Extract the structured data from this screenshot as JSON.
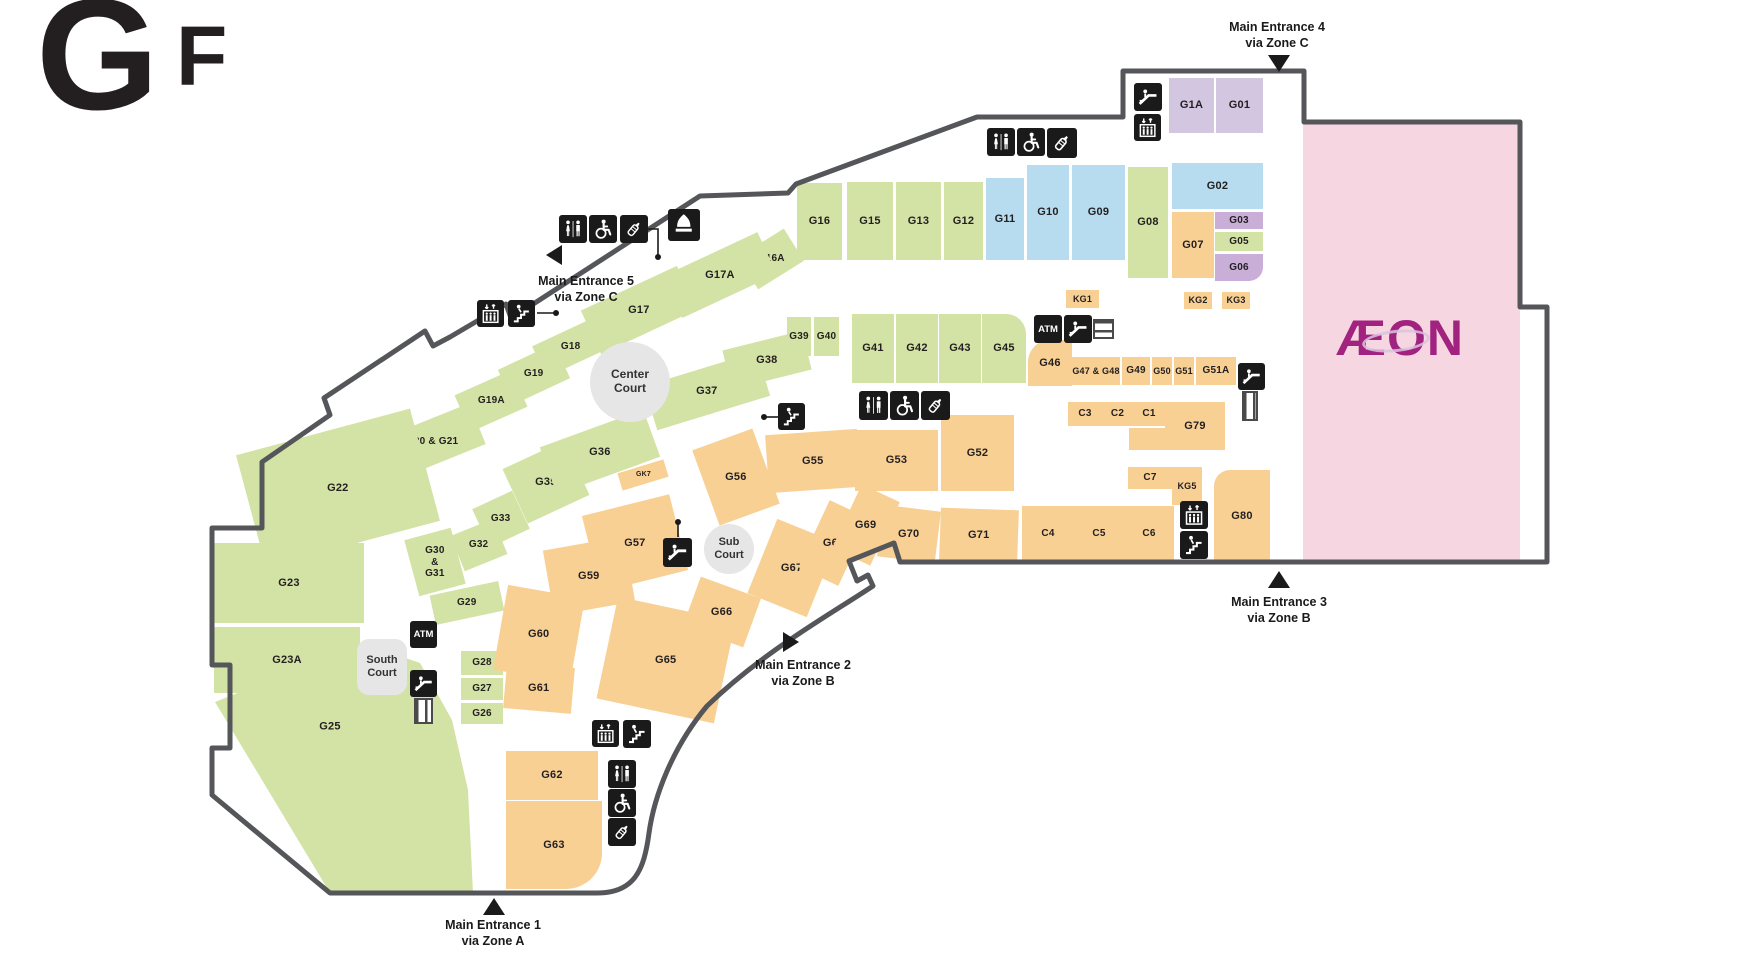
{
  "floor_label": {
    "char1": "G",
    "char2": "F"
  },
  "anchor": {
    "label": "ÆON"
  },
  "labels": {
    "atm": "ATM"
  },
  "palette": {
    "green": "#d3e2a5",
    "blue": "#b7dcf0",
    "orange": "#f8d094",
    "purple": "#c9aed8",
    "purple_light": "#d2c6e0",
    "pink": "#f6d7e1",
    "wall": "#55565a",
    "icon_bg": "#1a1a1a",
    "court": "#e6e6e6",
    "aeon_logo": "#a1227f"
  },
  "map": {
    "shops": [
      {
        "i": "G1A",
        "l": "G1A",
        "x": 1169,
        "y": 78,
        "w": 45,
        "h": 55,
        "c": "purple_light"
      },
      {
        "i": "G01",
        "l": "G01",
        "x": 1216,
        "y": 78,
        "w": 47,
        "h": 55,
        "c": "purple_light"
      },
      {
        "i": "G02",
        "l": "G02",
        "x": 1172,
        "y": 163,
        "w": 91,
        "h": 46,
        "c": "blue"
      },
      {
        "i": "G03",
        "l": "G03",
        "x": 1215,
        "y": 212,
        "w": 48,
        "h": 17,
        "c": "purple",
        "f": 10
      },
      {
        "i": "G05",
        "l": "G05",
        "x": 1215,
        "y": 232,
        "w": 48,
        "h": 19,
        "c": "green",
        "f": 10
      },
      {
        "i": "G06",
        "l": "G06",
        "x": 1215,
        "y": 254,
        "w": 48,
        "h": 27,
        "c": "purple",
        "f": 10,
        "rad": "0 0 14px 0"
      },
      {
        "i": "G07",
        "l": "G07",
        "x": 1172,
        "y": 212,
        "w": 42,
        "h": 66,
        "c": "orange"
      },
      {
        "i": "G08",
        "l": "G08",
        "x": 1128,
        "y": 167,
        "w": 40,
        "h": 111,
        "c": "green"
      },
      {
        "i": "G09",
        "l": "G09",
        "x": 1072,
        "y": 165,
        "w": 53,
        "h": 95,
        "c": "blue"
      },
      {
        "i": "G10",
        "l": "G10",
        "x": 1027,
        "y": 165,
        "w": 42,
        "h": 95,
        "c": "blue"
      },
      {
        "i": "G11",
        "l": "G11",
        "x": 986,
        "y": 178,
        "w": 38,
        "h": 82,
        "c": "blue"
      },
      {
        "i": "G12",
        "l": "G12",
        "x": 944,
        "y": 182,
        "w": 39,
        "h": 78,
        "c": "green"
      },
      {
        "i": "G13",
        "l": "G13",
        "x": 896,
        "y": 182,
        "w": 45,
        "h": 78,
        "c": "green"
      },
      {
        "i": "G15",
        "l": "G15",
        "x": 847,
        "y": 182,
        "w": 46,
        "h": 78,
        "c": "green"
      },
      {
        "i": "G16",
        "l": "G16",
        "x": 797,
        "y": 183,
        "w": 45,
        "h": 77,
        "c": "green"
      },
      {
        "i": "G16A",
        "l": "G16A",
        "x": 744,
        "y": 240,
        "w": 54,
        "h": 38,
        "c": "green",
        "r": -32,
        "f": 10
      },
      {
        "i": "G17A",
        "l": "G17A",
        "x": 668,
        "y": 252,
        "w": 104,
        "h": 46,
        "c": "green",
        "r": -25
      },
      {
        "i": "G17",
        "l": "G17",
        "x": 586,
        "y": 286,
        "w": 106,
        "h": 48,
        "c": "green",
        "r": -25
      },
      {
        "i": "G18",
        "l": "G18",
        "x": 536,
        "y": 330,
        "w": 70,
        "h": 34,
        "c": "green",
        "r": -25,
        "f": 10
      },
      {
        "i": "G19",
        "l": "G19",
        "x": 503,
        "y": 355,
        "w": 62,
        "h": 38,
        "c": "green",
        "r": -25,
        "f": 10
      },
      {
        "i": "G19A",
        "l": "G19A",
        "x": 460,
        "y": 381,
        "w": 62,
        "h": 40,
        "c": "green",
        "r": -24,
        "f": 10
      },
      {
        "i": "G20-G21",
        "l": "G20 & G21",
        "x": 383,
        "y": 420,
        "w": 98,
        "h": 44,
        "c": "green",
        "r": -22,
        "f": 10
      },
      {
        "i": "G22",
        "l": "G22",
        "x": 248,
        "y": 430,
        "w": 180,
        "h": 116,
        "c": "green",
        "r": -15
      },
      {
        "i": "G23",
        "l": "G23",
        "x": 214,
        "y": 543,
        "w": 150,
        "h": 80,
        "c": "green"
      },
      {
        "i": "G23A",
        "l": "G23A",
        "x": 214,
        "y": 627,
        "w": 146,
        "h": 66,
        "c": "green"
      },
      {
        "i": "G25",
        "l": "G25",
        "x": 212,
        "y": 640,
        "w": 265,
        "h": 253,
        "c": "green",
        "clip": "3,62 150,3 208,23 240,80 256,150 261,253 118,253",
        "lx": 118,
        "ly": 87
      },
      {
        "i": "G28",
        "l": "G28",
        "x": 461,
        "y": 651,
        "w": 42,
        "h": 24,
        "c": "green",
        "f": 10
      },
      {
        "i": "G27",
        "l": "G27",
        "x": 461,
        "y": 678,
        "w": 42,
        "h": 22,
        "c": "green",
        "f": 10
      },
      {
        "i": "G26",
        "l": "G26",
        "x": 461,
        "y": 703,
        "w": 42,
        "h": 21,
        "c": "green",
        "f": 10
      },
      {
        "i": "G29",
        "l": "G29",
        "x": 432,
        "y": 588,
        "w": 70,
        "h": 30,
        "c": "green",
        "r": -12,
        "f": 10
      },
      {
        "i": "G30-G31",
        "l": "G30\n&\nG31",
        "x": 411,
        "y": 533,
        "w": 48,
        "h": 58,
        "c": "green",
        "r": -15,
        "f": 10
      },
      {
        "i": "G32",
        "l": "G32",
        "x": 456,
        "y": 526,
        "w": 46,
        "h": 38,
        "c": "green",
        "r": -22,
        "f": 10
      },
      {
        "i": "G33",
        "l": "G33",
        "x": 479,
        "y": 498,
        "w": 44,
        "h": 42,
        "c": "green",
        "r": -25,
        "f": 10
      },
      {
        "i": "G35",
        "l": "G35",
        "x": 512,
        "y": 452,
        "w": 68,
        "h": 60,
        "c": "green",
        "r": -25
      },
      {
        "i": "G36",
        "l": "G36",
        "x": 545,
        "y": 427,
        "w": 110,
        "h": 50,
        "c": "green",
        "r": -20
      },
      {
        "i": "G37",
        "l": "G37",
        "x": 648,
        "y": 368,
        "w": 118,
        "h": 46,
        "c": "green",
        "r": -17
      },
      {
        "i": "G38",
        "l": "G38",
        "x": 726,
        "y": 340,
        "w": 82,
        "h": 40,
        "c": "green",
        "r": -14
      },
      {
        "i": "G39",
        "l": "G39",
        "x": 787,
        "y": 317,
        "w": 24,
        "h": 39,
        "c": "green",
        "f": 10
      },
      {
        "i": "G40",
        "l": "G40",
        "x": 814,
        "y": 317,
        "w": 25,
        "h": 39,
        "c": "green",
        "f": 10
      },
      {
        "i": "G41",
        "l": "G41",
        "x": 852,
        "y": 314,
        "w": 42,
        "h": 69,
        "c": "green"
      },
      {
        "i": "G42",
        "l": "G42",
        "x": 896,
        "y": 314,
        "w": 42,
        "h": 69,
        "c": "green"
      },
      {
        "i": "G43",
        "l": "G43",
        "x": 939,
        "y": 314,
        "w": 42,
        "h": 69,
        "c": "green"
      },
      {
        "i": "G45",
        "l": "G45",
        "x": 982,
        "y": 314,
        "w": 44,
        "h": 69,
        "c": "green",
        "rad": "0 20px 0 0"
      },
      {
        "i": "G46",
        "l": "G46",
        "x": 1028,
        "y": 340,
        "w": 44,
        "h": 46,
        "c": "orange",
        "rad": "22px 0 0 0"
      },
      {
        "i": "G47-G48",
        "l": "G47 & G48",
        "x": 1072,
        "y": 357,
        "w": 48,
        "h": 28,
        "c": "orange",
        "f": 9
      },
      {
        "i": "G49",
        "l": "G49",
        "x": 1122,
        "y": 357,
        "w": 28,
        "h": 28,
        "c": "orange",
        "f": 10
      },
      {
        "i": "G50",
        "l": "G50",
        "x": 1152,
        "y": 357,
        "w": 20,
        "h": 28,
        "c": "orange",
        "f": 9
      },
      {
        "i": "G51",
        "l": "G51",
        "x": 1174,
        "y": 357,
        "w": 20,
        "h": 28,
        "c": "orange",
        "f": 9
      },
      {
        "i": "G51A",
        "l": "G51A",
        "x": 1196,
        "y": 357,
        "w": 40,
        "h": 28,
        "c": "orange",
        "f": 10
      },
      {
        "i": "KG1",
        "l": "KG1",
        "x": 1066,
        "y": 290,
        "w": 33,
        "h": 18,
        "c": "orange",
        "f": 9
      },
      {
        "i": "KG2",
        "l": "KG2",
        "x": 1184,
        "y": 292,
        "w": 28,
        "h": 17,
        "c": "orange",
        "f": 9
      },
      {
        "i": "KG3",
        "l": "KG3",
        "x": 1222,
        "y": 292,
        "w": 28,
        "h": 17,
        "c": "orange",
        "f": 9
      },
      {
        "i": "C3",
        "l": "C3",
        "x": 1068,
        "y": 402,
        "w": 34,
        "h": 24,
        "c": "orange",
        "f": 10
      },
      {
        "i": "C2",
        "l": "C2",
        "x": 1102,
        "y": 402,
        "w": 31,
        "h": 24,
        "c": "orange",
        "f": 10
      },
      {
        "i": "C1",
        "l": "C1",
        "x": 1133,
        "y": 402,
        "w": 32,
        "h": 24,
        "c": "orange",
        "f": 10
      },
      {
        "i": "G79",
        "l": "G79",
        "x": 1165,
        "y": 402,
        "w": 60,
        "h": 48,
        "c": "orange"
      },
      {
        "i": "c-band",
        "l": "",
        "x": 1129,
        "y": 428,
        "w": 38,
        "h": 22,
        "c": "orange"
      },
      {
        "i": "C7",
        "l": "C7",
        "x": 1128,
        "y": 467,
        "w": 44,
        "h": 22,
        "c": "orange",
        "f": 10
      },
      {
        "i": "KG5",
        "l": "KG5",
        "x": 1172,
        "y": 467,
        "w": 30,
        "h": 38,
        "c": "orange",
        "f": 9
      },
      {
        "i": "C4",
        "l": "C4",
        "x": 1022,
        "y": 506,
        "w": 52,
        "h": 56,
        "c": "orange",
        "f": 10
      },
      {
        "i": "C5",
        "l": "C5",
        "x": 1074,
        "y": 506,
        "w": 50,
        "h": 56,
        "c": "orange",
        "f": 10
      },
      {
        "i": "C6",
        "l": "C6",
        "x": 1124,
        "y": 506,
        "w": 50,
        "h": 56,
        "c": "orange",
        "f": 10
      },
      {
        "i": "G80",
        "l": "G80",
        "x": 1214,
        "y": 470,
        "w": 56,
        "h": 92,
        "c": "orange",
        "rad": "16px 0 0 0"
      },
      {
        "i": "G52",
        "l": "G52",
        "x": 941,
        "y": 415,
        "w": 73,
        "h": 76,
        "c": "orange"
      },
      {
        "i": "G53",
        "l": "G53",
        "x": 855,
        "y": 430,
        "w": 83,
        "h": 61,
        "c": "orange"
      },
      {
        "i": "G55",
        "l": "G55",
        "x": 767,
        "y": 432,
        "w": 92,
        "h": 58,
        "c": "orange",
        "r": -4
      },
      {
        "i": "G56",
        "l": "G56",
        "x": 704,
        "y": 437,
        "w": 64,
        "h": 80,
        "c": "orange",
        "r": -20
      },
      {
        "i": "GK7",
        "l": "GK7",
        "x": 619,
        "y": 466,
        "w": 48,
        "h": 18,
        "c": "orange",
        "r": -17,
        "f": 7
      },
      {
        "i": "G57",
        "l": "G57",
        "x": 590,
        "y": 504,
        "w": 90,
        "h": 78,
        "c": "orange",
        "r": -14
      },
      {
        "i": "G59",
        "l": "G59",
        "x": 548,
        "y": 543,
        "w": 82,
        "h": 66,
        "c": "orange",
        "r": -10
      },
      {
        "i": "G60",
        "l": "G60",
        "x": 500,
        "y": 591,
        "w": 78,
        "h": 86,
        "c": "orange",
        "r": 10
      },
      {
        "i": "G61",
        "l": "G61",
        "x": 505,
        "y": 665,
        "w": 68,
        "h": 46,
        "c": "orange",
        "r": 5
      },
      {
        "i": "G62",
        "l": "G62",
        "x": 506,
        "y": 751,
        "w": 92,
        "h": 49,
        "c": "orange"
      },
      {
        "i": "G63",
        "l": "G63",
        "x": 506,
        "y": 801,
        "w": 96,
        "h": 88,
        "c": "orange",
        "rad": "0 0 36px 0"
      },
      {
        "i": "G65",
        "l": "G65",
        "x": 606,
        "y": 608,
        "w": 120,
        "h": 104,
        "c": "orange",
        "r": 12
      },
      {
        "i": "G66",
        "l": "G66",
        "x": 690,
        "y": 586,
        "w": 64,
        "h": 52,
        "c": "orange",
        "r": 20
      },
      {
        "i": "G67",
        "l": "G67",
        "x": 760,
        "y": 528,
        "w": 64,
        "h": 80,
        "c": "orange",
        "r": 22
      },
      {
        "i": "G68",
        "l": "G68",
        "x": 812,
        "y": 506,
        "w": 44,
        "h": 74,
        "c": "orange",
        "r": 25
      },
      {
        "i": "G69",
        "l": "G69",
        "x": 845,
        "y": 490,
        "w": 42,
        "h": 70,
        "c": "orange",
        "r": 25
      },
      {
        "i": "G70",
        "l": "G70",
        "x": 880,
        "y": 508,
        "w": 58,
        "h": 52,
        "c": "orange",
        "r": 7
      },
      {
        "i": "G71",
        "l": "G71",
        "x": 940,
        "y": 509,
        "w": 78,
        "h": 53,
        "c": "orange",
        "r": 2
      },
      {
        "i": "aeon-store",
        "l": "",
        "x": 1303,
        "y": 124,
        "w": 217,
        "h": 436,
        "c": "pink"
      }
    ],
    "courts": [
      {
        "id": "center-court",
        "label": "Center\nCourt",
        "shape": "circle",
        "cx": 630,
        "cy": 382,
        "r": 40,
        "fs": 12
      },
      {
        "id": "sub-court",
        "label": "Sub\nCourt",
        "shape": "circle",
        "cx": 729,
        "cy": 549,
        "r": 25,
        "fs": 11
      },
      {
        "id": "south-court",
        "label": "South\nCourt",
        "shape": "rect",
        "x": 357,
        "y": 639,
        "w": 50,
        "h": 56,
        "fs": 11
      }
    ],
    "entrances": [
      {
        "id": "1",
        "lines": [
          "Main Entrance 1",
          "via Zone A"
        ],
        "dir": "up",
        "tri": [
          483,
          898
        ],
        "label_pos": [
          418,
          918
        ]
      },
      {
        "id": "2",
        "lines": [
          "Main Entrance 2",
          "via Zone B"
        ],
        "dir": "right",
        "tri": [
          783,
          632
        ],
        "label_pos": [
          728,
          658
        ]
      },
      {
        "id": "3",
        "lines": [
          "Main Entrance 3",
          "via Zone B"
        ],
        "dir": "up",
        "tri": [
          1268,
          571
        ],
        "label_pos": [
          1204,
          595
        ]
      },
      {
        "id": "4",
        "lines": [
          "Main Entrance 4",
          "via Zone C"
        ],
        "dir": "down",
        "tri": [
          1268,
          55
        ],
        "label_pos": [
          1202,
          20
        ]
      },
      {
        "id": "5",
        "lines": [
          "Main Entrance 5",
          "via Zone C"
        ],
        "dir": "left",
        "tri": [
          546,
          245
        ],
        "label_pos": [
          511,
          274
        ]
      }
    ],
    "icons": [
      {
        "t": "wc",
        "x": 559,
        "y": 215
      },
      {
        "t": "wheelchair",
        "x": 589,
        "y": 215
      },
      {
        "t": "baby",
        "x": 620,
        "y": 215
      },
      {
        "t": "prayer",
        "x": 668,
        "y": 209,
        "s": 32
      },
      {
        "t": "elevator",
        "x": 477,
        "y": 300,
        "s": 27
      },
      {
        "t": "stairs",
        "x": 508,
        "y": 300,
        "s": 27
      },
      {
        "t": "wc",
        "x": 987,
        "y": 128
      },
      {
        "t": "wheelchair",
        "x": 1017,
        "y": 128
      },
      {
        "t": "baby",
        "x": 1047,
        "y": 128,
        "s": 30
      },
      {
        "t": "escalator",
        "x": 1134,
        "y": 83
      },
      {
        "t": "elevator",
        "x": 1134,
        "y": 114,
        "s": 27
      },
      {
        "t": "atm",
        "x": 1034,
        "y": 315
      },
      {
        "t": "escalator",
        "x": 1064,
        "y": 315
      },
      {
        "t": "escalator",
        "x": 1238,
        "y": 363,
        "s": 27
      },
      {
        "t": "stairs",
        "x": 778,
        "y": 403,
        "s": 27
      },
      {
        "t": "wc",
        "x": 859,
        "y": 391,
        "s": 29
      },
      {
        "t": "wheelchair",
        "x": 890,
        "y": 391,
        "s": 29
      },
      {
        "t": "baby",
        "x": 921,
        "y": 391,
        "s": 29
      },
      {
        "t": "escalator",
        "x": 663,
        "y": 538,
        "s": 29
      },
      {
        "t": "atm",
        "x": 410,
        "y": 621,
        "s": 27
      },
      {
        "t": "escalator",
        "x": 410,
        "y": 670,
        "s": 27
      },
      {
        "t": "elevator",
        "x": 1180,
        "y": 501
      },
      {
        "t": "stairs",
        "x": 1180,
        "y": 531
      },
      {
        "t": "elevator",
        "x": 592,
        "y": 720,
        "s": 27
      },
      {
        "t": "stairs",
        "x": 623,
        "y": 720
      },
      {
        "t": "wc",
        "x": 608,
        "y": 760
      },
      {
        "t": "wheelchair",
        "x": 608,
        "y": 789
      },
      {
        "t": "baby",
        "x": 608,
        "y": 818
      }
    ],
    "ramps": [
      {
        "x": 1093,
        "y": 319,
        "w": 21,
        "h": 20,
        "dir": "h"
      },
      {
        "x": 1242,
        "y": 391,
        "w": 16,
        "h": 30,
        "dir": "v"
      },
      {
        "x": 414,
        "y": 698,
        "w": 19,
        "h": 26,
        "dir": "v"
      }
    ],
    "connectors": [
      {
        "pts": [
          [
            537,
            313
          ],
          [
            556,
            313
          ]
        ],
        "dot": [
          556,
          313
        ]
      },
      {
        "pts": [
          [
            648,
            229
          ],
          [
            658,
            229
          ],
          [
            658,
            257
          ]
        ],
        "dot": [
          658,
          257
        ]
      },
      {
        "pts": [
          [
            779,
            417
          ],
          [
            764,
            417
          ]
        ],
        "dot": [
          764,
          417
        ]
      },
      {
        "pts": [
          [
            678,
            537
          ],
          [
            678,
            522
          ]
        ],
        "dot": [
          678,
          522
        ]
      }
    ]
  }
}
